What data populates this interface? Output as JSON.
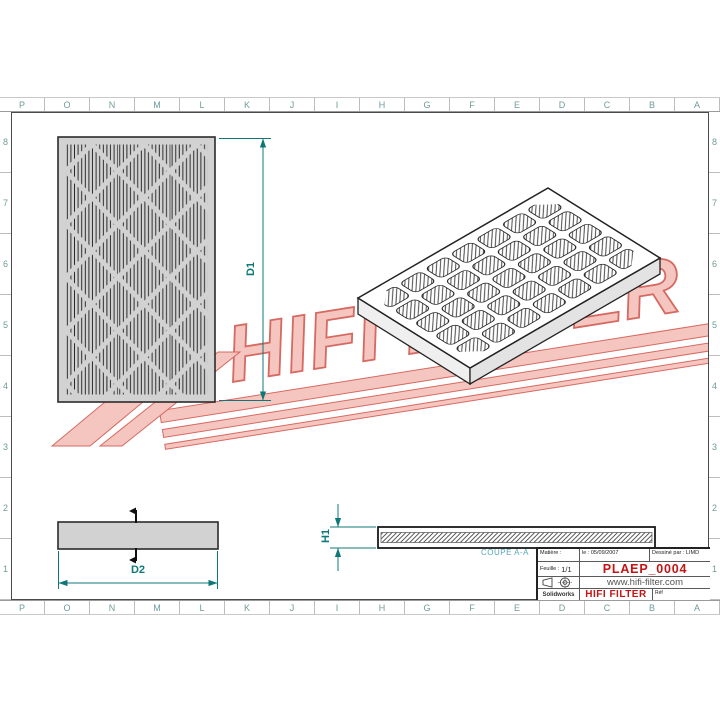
{
  "sheet": {
    "column_labels": [
      "P",
      "O",
      "N",
      "M",
      "L",
      "K",
      "J",
      "I",
      "H",
      "G",
      "F",
      "E",
      "D",
      "C",
      "B",
      "A"
    ],
    "row_labels": [
      "8",
      "7",
      "6",
      "5",
      "4",
      "3",
      "2",
      "1"
    ]
  },
  "dimensions": {
    "height": "D1",
    "width": "D2",
    "thickness": "H1"
  },
  "section": {
    "label": "COUPE A-A"
  },
  "title_block": {
    "material_label": "Matière :",
    "date": "le : 05/09/2007",
    "drawn_by": "Dessiné par : LIMD",
    "sheet_label": "Feuille :",
    "sheet_value": "1/1",
    "part_number": "PLAEP_0004",
    "website": "www.hifi-filter.com",
    "software": "Solidworks",
    "brand": "HIFI FILTER",
    "ref_label": "Réf"
  },
  "watermark": {
    "text": "HIFI FILTER"
  },
  "colors": {
    "dimension_teal": "#0e7878",
    "grid_label": "#6f9b9b",
    "accent_red": "#c41414",
    "section_label": "#57a7b6",
    "watermark_fill": "#f4bcb4",
    "watermark_stroke": "#d05046",
    "panel_gray": "#d2d2d2"
  }
}
